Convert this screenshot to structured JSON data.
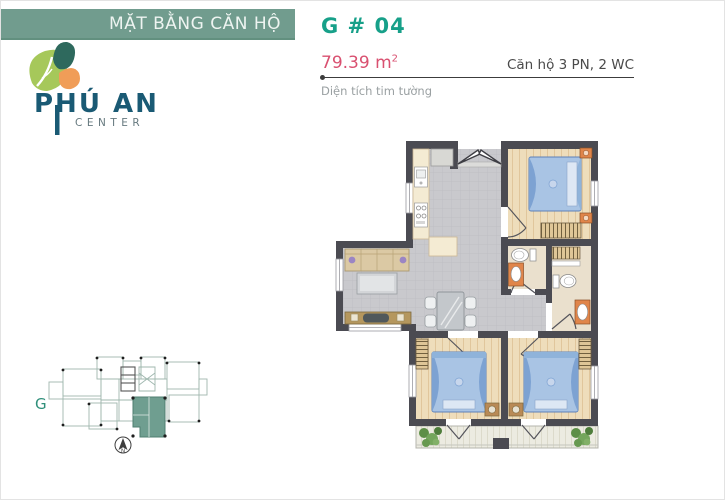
{
  "header": {
    "bar_title": "MẶT BẰNG CĂN HỘ",
    "unit_code": "G # 04",
    "area_value": "79.39 m",
    "area_exponent": "2",
    "unit_spec": "Căn hộ 3 PN, 2 WC",
    "area_note": "Diện tích tim tường"
  },
  "logo": {
    "name": "PHÚ AN",
    "subtitle": "CENTER"
  },
  "key_plan": {
    "block_label": "G",
    "compass_label": "N"
  },
  "colors": {
    "title_bar": "#719C8E",
    "accent_teal": "#17A089",
    "accent_pink": "#D95070",
    "wall": "#4B4B52",
    "logo_navy": "#1A5A74",
    "leaf_green": "#A6C85A",
    "leaf_teal": "#2E695D",
    "leaf_orange": "#F09D58",
    "key_plan_unit": "#6F9E90",
    "wood_floor": "#EEDDBB",
    "tile_floor": "#C9C9CD"
  }
}
